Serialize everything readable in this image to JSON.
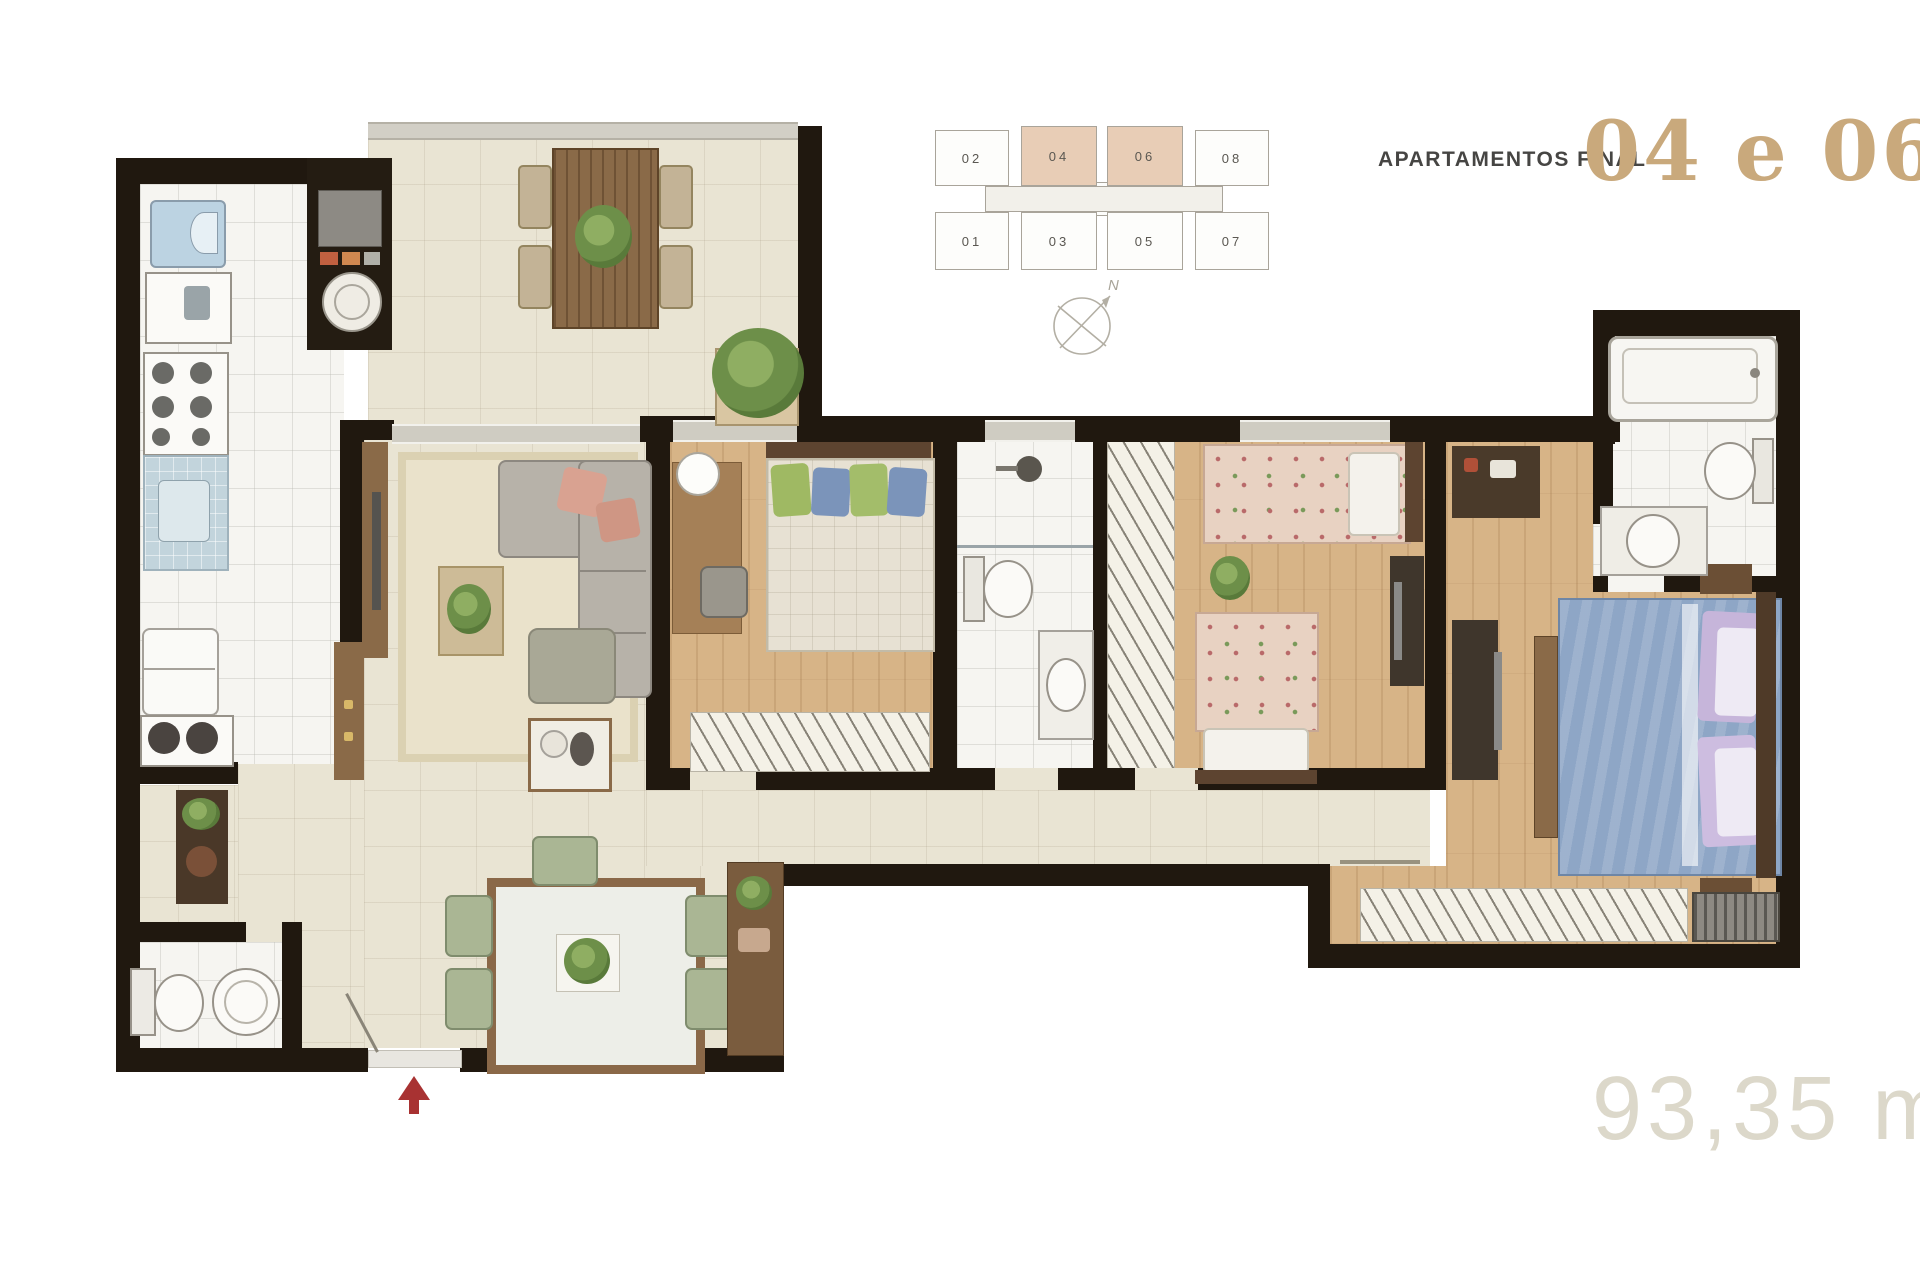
{
  "header": {
    "title_label": "APARTAMENTOS FINAL",
    "title_units": "04 e 06"
  },
  "area_label": "93,35 m²",
  "key_plan": {
    "rows": [
      {
        "cells": [
          {
            "label": "02",
            "highlighted": false
          },
          {
            "label": "04",
            "highlighted": true
          },
          {
            "label": "06",
            "highlighted": true
          },
          {
            "label": "08",
            "highlighted": false
          }
        ]
      },
      {
        "cells": [
          {
            "label": "01",
            "highlighted": false
          },
          {
            "label": "03",
            "highlighted": false
          },
          {
            "label": "05",
            "highlighted": false
          },
          {
            "label": "07",
            "highlighted": false
          }
        ]
      }
    ]
  },
  "compass": {
    "north_label": "N"
  },
  "colors": {
    "accent_gold": "#c9a97c",
    "keyplan_highlight": "#e8cdb6",
    "wall": "#20180f",
    "wood_floor": "#d7b487",
    "tile_beige": "#e9e4d3",
    "tile_white": "#f6f5f1",
    "area_text": "#dcd8ca",
    "entry_arrow": "#a83232"
  }
}
